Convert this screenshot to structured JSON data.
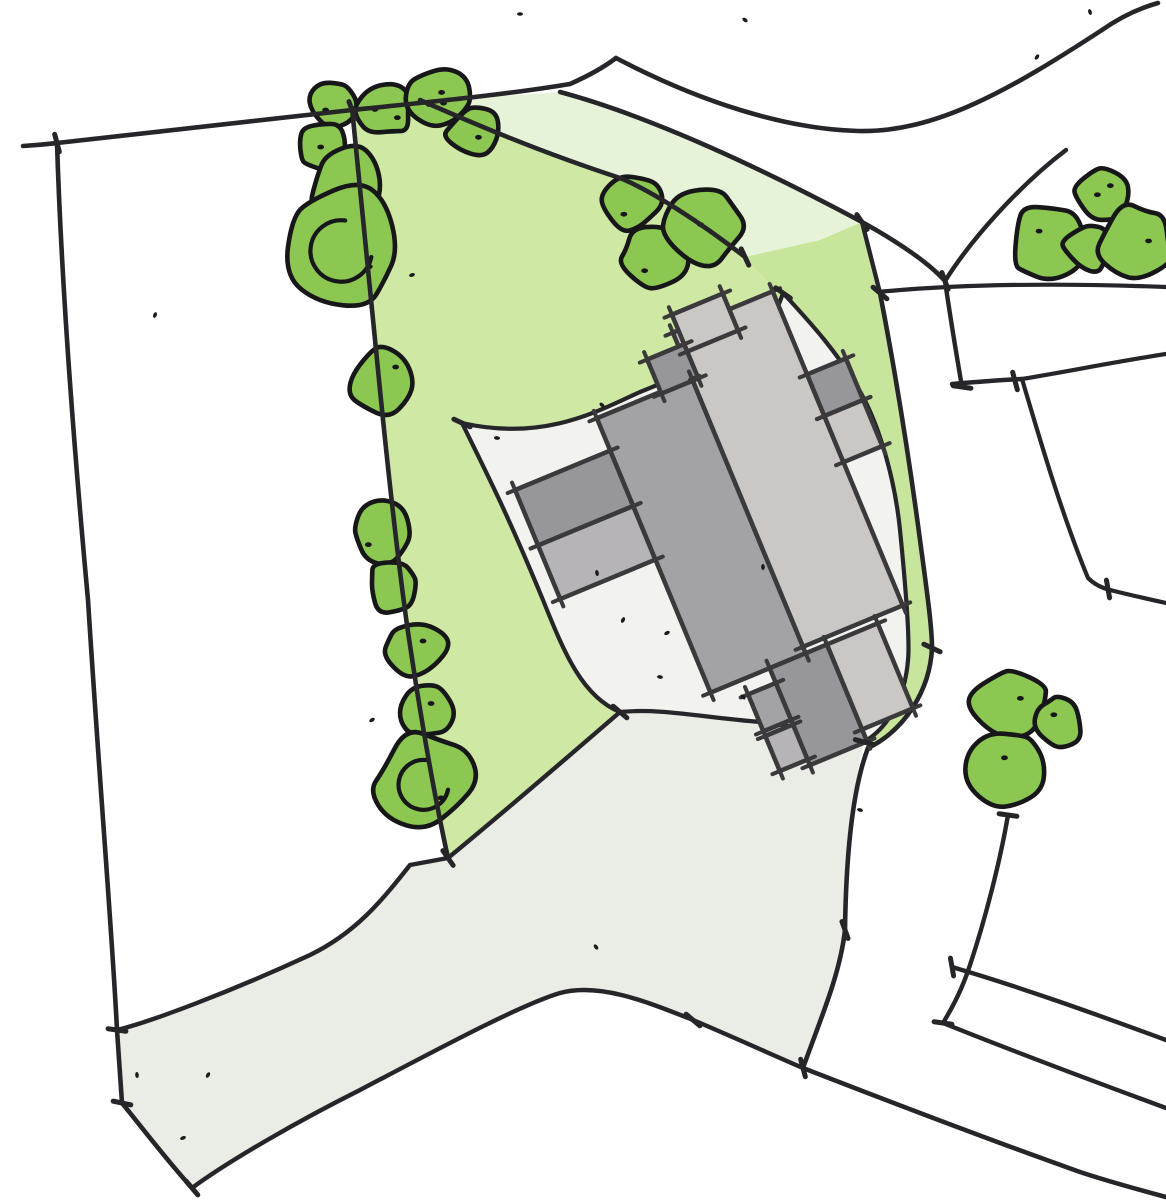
{
  "title": "Hand-drawn architectural site plan sketch with building footprint, lawn, trees, driveway and plot boundaries",
  "canvas": {
    "width": 1166,
    "height": 1200,
    "background": "#ffffff"
  },
  "palette": {
    "ink": "#26262a",
    "tree_outline": "#17171a",
    "tree_fill": "#8cc751",
    "lawn": "#cfe9a5",
    "lawn_strip": "#c8e69b",
    "verge_pale": "#e7f3d9",
    "hardscape": "#eaece6",
    "courtyard": "#f2f3ef",
    "building_outline": "#3a393b",
    "building_dark": "#97969a",
    "building_mid": "#a3a2a4",
    "building_light": "#cbc7c4",
    "building_pale": "#b6b4b6",
    "speck": "#1b1b1d"
  },
  "areas": [
    {
      "name": "lawn-main",
      "fill": "lawn",
      "d": "M352,108 L420,100 C470,122 540,152 620,178 C650,190 700,222 745,257 C760,275 770,285 783,293 C778,308 772,322 763,333 C725,355 690,372 640,392 C600,410 545,442 462,423 C490,480 507,513 543,600 C565,655 583,697 620,712 C540,781 470,840 448,858 C432,785 417,695 407,625 C398,560 388,470 380,390 C372,310 362,210 352,108 Z"
    },
    {
      "name": "verge-pale-green",
      "fill": "verge_pale",
      "d": "M420,100 C470,122 540,152 620,178 C650,190 700,222 745,257 L820,240 L862,222 C765,170 650,116 560,92 C510,96 460,98 420,100 Z"
    },
    {
      "name": "lawn-neck-strip",
      "fill": "lawn_strip",
      "d": "M745,257 L820,240 L862,222 C868,245 874,270 880,293 C893,360 905,430 918,525 C926,585 932,625 932,648 C930,690 905,730 868,748 L864,742 C888,728 905,698 908,660 C910,640 906,590 900,530 C895,480 880,428 862,395 C840,355 810,322 783,293 C770,285 760,275 745,257 Z"
    },
    {
      "name": "hardscape-driveway",
      "fill": "hardscape",
      "d": "M462,423 C545,442 600,410 640,392 C690,372 725,355 763,333 C772,322 778,308 783,293 C810,322 840,355 862,395 C880,428 895,480 900,530 C906,590 910,640 908,660 C905,698 888,728 864,742 C852,790 846,860 845,930 C840,975 820,1020 803,1068 C775,1056 740,1040 693,1020 C650,1003 600,982 560,993 C520,1005 440,1048 360,1090 C300,1120 230,1160 192,1188 L122,1103 L117,1030 C150,1022 230,992 310,955 C355,933 380,903 410,865 L448,858 C470,840 540,781 620,712 C583,697 565,655 543,600 C507,513 490,480 462,423 Z"
    },
    {
      "name": "courtyard",
      "fill": "courtyard",
      "d": "M462,423 C545,442 600,410 640,392 C690,372 725,355 763,333 C772,322 778,308 783,293 C810,322 840,355 862,395 C880,428 895,480 900,530 C906,590 910,640 908,660 C905,698 888,728 864,742 C840,737 810,728 760,722 C700,717 660,708 620,712 C583,697 565,655 543,600 C507,513 490,480 462,423 Z"
    }
  ],
  "lines": [
    {
      "name": "northwest-plot-boundary",
      "w": 4.6,
      "d": "M23,146 C40,145 48,144 57,143 C160,132 260,120 352,110 C440,101 510,94 570,84 C588,76 603,68 616,58"
    },
    {
      "name": "road-north-edge",
      "w": 4.6,
      "d": "M616,58 C700,102 785,129 858,131 C935,133 1010,90 1102,30 C1122,16 1140,8 1158,3"
    },
    {
      "name": "west-boundary",
      "w": 4.6,
      "d": "M57,143 C62,300 76,470 88,600 C100,790 112,930 117,1030 L122,1103"
    },
    {
      "name": "driveway-west-edge",
      "w": 4.6,
      "d": "M122,1103 C140,1125 165,1158 192,1188"
    },
    {
      "name": "driveway-south-edge",
      "w": 4.4,
      "d": "M192,1188 C230,1160 300,1120 360,1090 C440,1048 520,1005 560,993 C600,982 650,1003 693,1020 C740,1040 775,1056 803,1068"
    },
    {
      "name": "southeast-boundary",
      "w": 4.6,
      "d": "M803,1068 C880,1098 990,1140 1080,1172 C1110,1182 1140,1190 1166,1197"
    },
    {
      "name": "driveway-top-edge",
      "w": 4.4,
      "d": "M117,1030 C150,1022 230,992 310,955 C355,933 380,903 410,865 L448,858 C470,840 540,781 620,712"
    },
    {
      "name": "courtyard-south-edge",
      "w": 4.2,
      "d": "M620,712 C660,708 700,717 760,722 C810,728 840,737 864,742"
    },
    {
      "name": "site-east-boundary",
      "w": 4.6,
      "d": "M880,293 C893,360 905,430 918,525 C926,585 932,625 932,648 C930,690 905,730 868,748 C852,790 846,860 845,930 C840,975 820,1020 803,1068"
    },
    {
      "name": "strip-west-edge",
      "w": 4.2,
      "d": "M783,293 C810,322 840,355 862,395 C880,428 895,480 900,530 C906,590 910,640 908,660 C905,698 888,728 864,742"
    },
    {
      "name": "courtyard-north-edge",
      "w": 4.2,
      "d": "M462,423 C545,442 600,410 640,392 C690,372 725,355 763,333 C772,322 778,308 783,293"
    },
    {
      "name": "courtyard-west-edge",
      "w": 4.2,
      "d": "M462,423 C490,480 507,513 543,600 C565,655 583,697 620,712"
    },
    {
      "name": "lawn-tree-boundary",
      "w": 4.6,
      "d": "M352,108 C362,210 372,310 380,390 C388,470 398,560 407,625 C417,695 432,785 448,858"
    },
    {
      "name": "verge-tree-boundary",
      "w": 4.6,
      "d": "M420,100 C470,122 540,152 620,178 C650,190 700,222 745,257"
    },
    {
      "name": "road-south-edge",
      "w": 4.6,
      "d": "M560,92 C650,116 765,170 862,222 C898,242 928,262 945,281"
    },
    {
      "name": "road-stub-east-edge",
      "w": 4.4,
      "d": "M1066,150 C1020,185 972,238 945,281"
    },
    {
      "name": "right-horizontal-boundary",
      "w": 4.2,
      "d": "M878,292 C960,284 1060,283 1166,287"
    },
    {
      "name": "right-plot-vertical",
      "w": 4.4,
      "d": "M945,281 C950,315 956,352 962,387"
    },
    {
      "name": "right-plot-jog",
      "w": 4.4,
      "d": "M952,384 C975,382 1000,380 1022,379"
    },
    {
      "name": "right-plot-east-line",
      "w": 4.2,
      "d": "M1022,379 C1070,371 1120,361 1166,354"
    },
    {
      "name": "right-plot-south-line",
      "w": 4.2,
      "d": "M1022,379 C1040,440 1062,515 1088,578 C1095,585 1102,588 1110,590 C1130,595 1148,599 1166,603"
    },
    {
      "name": "bottomright-vertical",
      "w": 4.4,
      "d": "M1008,815 C1000,862 985,920 970,965 C962,990 952,1008 943,1023"
    },
    {
      "name": "bottomright-line-a",
      "w": 4.4,
      "d": "M952,967 C1020,987 1090,1012 1166,1040"
    },
    {
      "name": "bottomright-line-b",
      "w": 4.4,
      "d": "M943,1023 C1010,1050 1090,1080 1166,1108"
    },
    {
      "name": "verge-east-close",
      "w": 4.4,
      "d": "M862,222 C868,245 874,270 880,293"
    }
  ],
  "building": {
    "rotation": -22.5,
    "cx": 700,
    "cy": 500,
    "outline_w": 4.5,
    "parts": [
      {
        "name": "left-wing-dark",
        "x": 533,
        "y": 420,
        "w": 103,
        "h": 60,
        "fill": "building_dark"
      },
      {
        "name": "left-wing-pale",
        "x": 533,
        "y": 480,
        "w": 103,
        "h": 58,
        "fill": "building_pale"
      },
      {
        "name": "main-wing",
        "x": 636,
        "y": 385,
        "w": 103,
        "h": 297,
        "fill": "building_mid"
      },
      {
        "name": "right-wing",
        "x": 739,
        "y": 335,
        "w": 108,
        "h": 340,
        "fill": "building_light"
      },
      {
        "name": "top-porch-light",
        "x": 745,
        "y": 318,
        "w": 55,
        "h": 40,
        "fill": "building_light"
      },
      {
        "name": "top-porch-dark",
        "x": 705,
        "y": 350,
        "w": 40,
        "h": 37,
        "fill": "building_dark"
      },
      {
        "name": "east-block-dark",
        "x": 847,
        "y": 425,
        "w": 42,
        "h": 45,
        "fill": "building_dark"
      },
      {
        "name": "east-block-light",
        "x": 847,
        "y": 470,
        "w": 42,
        "h": 50,
        "fill": "building_light"
      },
      {
        "name": "south-ext-dark",
        "x": 700,
        "y": 682,
        "w": 62,
        "h": 105,
        "fill": "building_dark"
      },
      {
        "name": "south-ext-light",
        "x": 762,
        "y": 682,
        "w": 55,
        "h": 92,
        "fill": "building_light"
      },
      {
        "name": "south-annex-a",
        "x": 670,
        "y": 698,
        "w": 30,
        "h": 40,
        "fill": "building_mid"
      },
      {
        "name": "south-annex-b",
        "x": 670,
        "y": 743,
        "w": 30,
        "h": 38,
        "fill": "building_pale"
      }
    ]
  },
  "trees": [
    {
      "name": "tree",
      "cx": 334,
      "cy": 104,
      "r": 25,
      "seed": 11,
      "dots": 1
    },
    {
      "name": "tree",
      "cx": 385,
      "cy": 110,
      "r": 28,
      "seed": 12,
      "dots": 2
    },
    {
      "name": "tree",
      "cx": 440,
      "cy": 98,
      "r": 34,
      "seed": 13,
      "dots": 3
    },
    {
      "name": "tree",
      "cx": 473,
      "cy": 132,
      "r": 28,
      "seed": 14,
      "dots": 1
    },
    {
      "name": "tree",
      "cx": 322,
      "cy": 147,
      "r": 26,
      "seed": 15,
      "dots": 1
    },
    {
      "name": "tree",
      "cx": 348,
      "cy": 185,
      "r": 40,
      "seed": 16,
      "dots": 0
    },
    {
      "name": "tree",
      "cx": 343,
      "cy": 245,
      "r": 64,
      "seed": 17,
      "dots": 1,
      "swirl": true
    },
    {
      "name": "tree",
      "cx": 382,
      "cy": 382,
      "r": 34,
      "seed": 21,
      "dots": 1
    },
    {
      "name": "tree",
      "cx": 382,
      "cy": 531,
      "r": 33,
      "seed": 22,
      "dots": 1
    },
    {
      "name": "tree",
      "cx": 394,
      "cy": 587,
      "r": 28,
      "seed": 23,
      "dots": 0
    },
    {
      "name": "tree",
      "cx": 415,
      "cy": 650,
      "r": 31,
      "seed": 24,
      "dots": 1
    },
    {
      "name": "tree",
      "cx": 424,
      "cy": 710,
      "r": 30,
      "seed": 25,
      "dots": 1
    },
    {
      "name": "tree",
      "cx": 425,
      "cy": 780,
      "r": 52,
      "seed": 26,
      "dots": 1,
      "swirl": true
    },
    {
      "name": "tree",
      "cx": 632,
      "cy": 201,
      "r": 30,
      "seed": 31,
      "dots": 1
    },
    {
      "name": "tree",
      "cx": 654,
      "cy": 256,
      "r": 34,
      "seed": 32,
      "dots": 1
    },
    {
      "name": "tree",
      "cx": 706,
      "cy": 226,
      "r": 40,
      "seed": 33,
      "dots": 1
    },
    {
      "name": "tree",
      "cx": 1049,
      "cy": 243,
      "r": 40,
      "seed": 41,
      "dots": 1
    },
    {
      "name": "tree",
      "cx": 1103,
      "cy": 194,
      "r": 28,
      "seed": 42,
      "dots": 2
    },
    {
      "name": "tree",
      "cx": 1088,
      "cy": 248,
      "r": 26,
      "seed": 43,
      "dots": 0
    },
    {
      "name": "tree",
      "cx": 1135,
      "cy": 242,
      "r": 40,
      "seed": 44,
      "dots": 1
    },
    {
      "name": "tree",
      "cx": 1013,
      "cy": 704,
      "r": 40,
      "seed": 51,
      "dots": 1
    },
    {
      "name": "tree",
      "cx": 1059,
      "cy": 723,
      "r": 26,
      "seed": 52,
      "dots": 1
    },
    {
      "name": "tree",
      "cx": 1005,
      "cy": 770,
      "r": 38,
      "seed": 53,
      "dots": 1
    }
  ],
  "ticks": [
    [
      57,
      143,
      75
    ],
    [
      352,
      110,
      70
    ],
    [
      448,
      858,
      55
    ],
    [
      620,
      712,
      40
    ],
    [
      117,
      1030,
      8
    ],
    [
      122,
      1103,
      12
    ],
    [
      192,
      1188,
      50
    ],
    [
      803,
      1068,
      75
    ],
    [
      862,
      222,
      55
    ],
    [
      745,
      257,
      65
    ],
    [
      945,
      281,
      70
    ],
    [
      1015,
      381,
      75
    ],
    [
      962,
      387,
      8
    ],
    [
      1108,
      589,
      80
    ],
    [
      1008,
      815,
      8
    ],
    [
      952,
      967,
      80
    ],
    [
      943,
      1023,
      8
    ],
    [
      880,
      293,
      40
    ],
    [
      932,
      648,
      25
    ],
    [
      864,
      742,
      15
    ],
    [
      462,
      423,
      25
    ],
    [
      783,
      293,
      35
    ],
    [
      845,
      930,
      70
    ],
    [
      693,
      1020,
      40
    ]
  ],
  "specks": [
    [
      520,
      14
    ],
    [
      745,
      20
    ],
    [
      1090,
      12
    ],
    [
      155,
      315
    ],
    [
      372,
      720
    ],
    [
      497,
      438
    ],
    [
      602,
      405
    ],
    [
      597,
      573
    ],
    [
      623,
      620
    ],
    [
      667,
      633
    ],
    [
      660,
      677
    ],
    [
      743,
      697
    ],
    [
      137,
      1075
    ],
    [
      208,
      1075
    ],
    [
      183,
      1138
    ],
    [
      860,
      810
    ],
    [
      596,
      947
    ],
    [
      763,
      567
    ],
    [
      1037,
      57
    ],
    [
      412,
      275
    ]
  ]
}
